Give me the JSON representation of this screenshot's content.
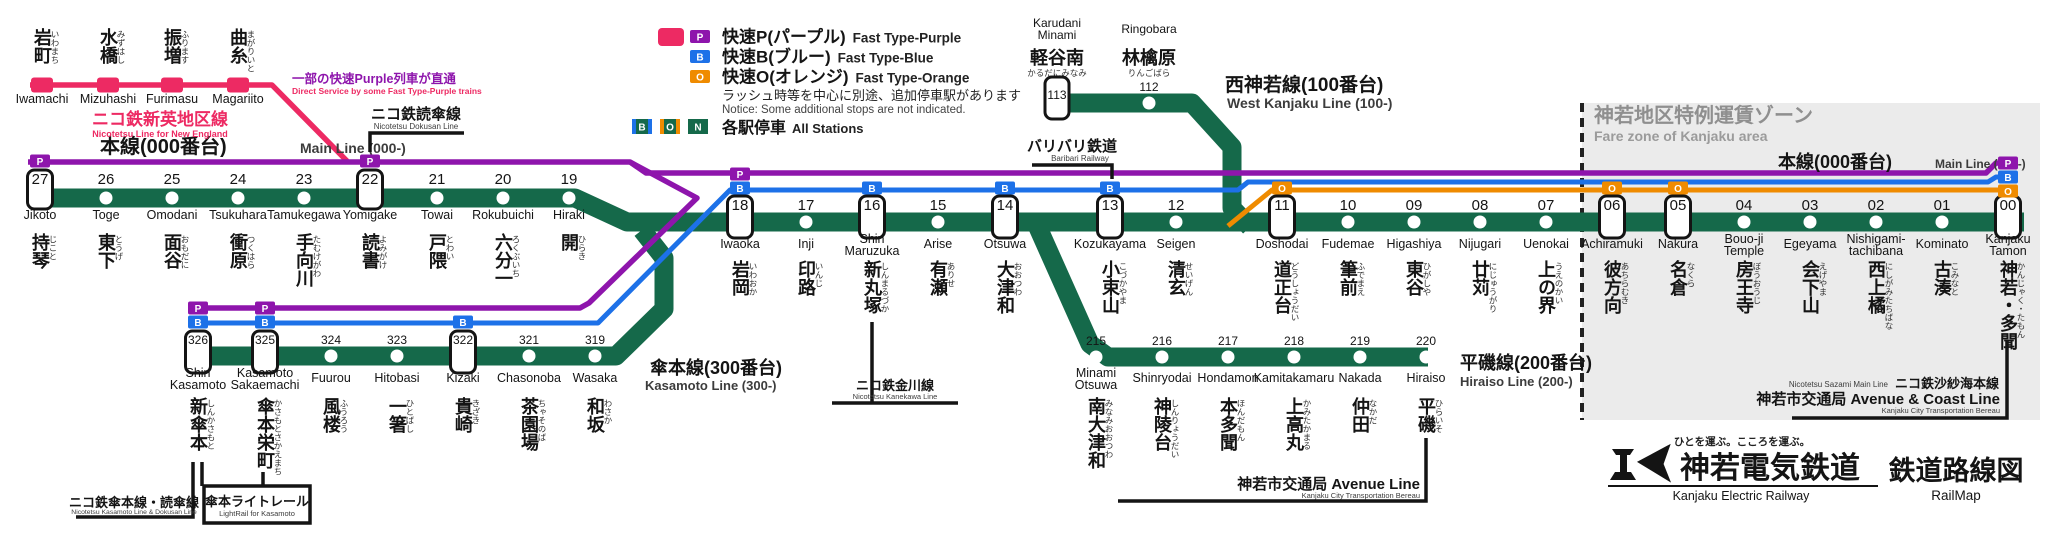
{
  "colors": {
    "green": "#15694A",
    "purple": "#8E15AC",
    "blue": "#1D71E8",
    "orange": "#EF8B00",
    "pink": "#ED2A63",
    "text": "#141414",
    "subtext": "#3C3C3C",
    "zone_bg": "#EBEBEB",
    "zone_text": "#8F8F8F",
    "white": "#FFFFFF"
  },
  "legend": {
    "rows": [
      {
        "badges": [
          "pink-rect",
          "P"
        ],
        "jp": "快速P(パープル)",
        "en": "Fast Type-Purple"
      },
      {
        "badges": [
          "B"
        ],
        "jp": "快速B(ブルー)",
        "en": "Fast Type-Blue"
      },
      {
        "badges": [
          "O"
        ],
        "jp": "快速O(オレンジ)",
        "en": "Fast Type-Orange"
      }
    ],
    "notice_jp": "ラッシュ時等を中心に別途、追加停車駅があります",
    "notice_en": "Notice: Some additional stops are not indicated.",
    "local": {
      "badges": [
        "B",
        "O",
        "N"
      ],
      "jp": "各駅停車",
      "en": "All Stations"
    }
  },
  "fare_zone": {
    "jp": "神若地区特例運賃ゾーン",
    "en": "Fare zone of Kanjaku area"
  },
  "line_labels": {
    "main_left": {
      "jp": "本線(000番台)",
      "en": "Main Line (000-)"
    },
    "main_right": {
      "jp": "本線(000番台)",
      "en": "Main Line (000-)"
    },
    "west": {
      "jp": "西神若線(100番台)",
      "en": "West Kanjaku Line (100-)"
    },
    "kasamoto": {
      "jp": "傘本線(300番台)",
      "en": "Kasamoto Line (300-)"
    },
    "hiraiso": {
      "jp": "平磯線(200番台)",
      "en": "Hiraiso Line (200-)"
    },
    "new_england": {
      "jp": "ニコ鉄新英地区線",
      "en": "Nicotetsu Line for New England",
      "note_jp": "一部の快速Purple列車が直通",
      "note_en": "Direct Service by some Fast Type-Purple trains"
    }
  },
  "stations": {
    "main_left": [
      {
        "num": "27",
        "name": "持琴",
        "kana": "じこと",
        "romaji": [
          "Jikoto"
        ],
        "x": 40,
        "fast": true,
        "badges": [
          "P"
        ]
      },
      {
        "num": "26",
        "name": "東下",
        "kana": "とうげ",
        "romaji": [
          "Toge"
        ],
        "x": 106
      },
      {
        "num": "25",
        "name": "面谷",
        "kana": "おもだに",
        "romaji": [
          "Omodani"
        ],
        "x": 172
      },
      {
        "num": "24",
        "name": "衝原",
        "kana": "つくはら",
        "romaji": [
          "Tsukuhara"
        ],
        "x": 238
      },
      {
        "num": "23",
        "name": "手向川",
        "kana": "たむけがわ",
        "romaji": [
          "Tamukegawa"
        ],
        "x": 304
      },
      {
        "num": "22",
        "name": "読書",
        "kana": "よみがけ",
        "romaji": [
          "Yomigake"
        ],
        "x": 370,
        "fast": true,
        "badges": [
          "P"
        ]
      },
      {
        "num": "21",
        "name": "戸隈",
        "kana": "とわい",
        "romaji": [
          "Towai"
        ],
        "x": 437
      },
      {
        "num": "20",
        "name": "六分一",
        "kana": "ろくぶいち",
        "romaji": [
          "Rokubuichi"
        ],
        "x": 503
      },
      {
        "num": "19",
        "name": "開",
        "kana": "ひらき",
        "romaji": [
          "Hiraki"
        ],
        "x": 569
      }
    ],
    "main_mid": [
      {
        "num": "18",
        "name": "岩岡",
        "kana": "いわおか",
        "romaji": [
          "Iwaoka"
        ],
        "x": 740,
        "fast": true,
        "badges": [
          "P",
          "B"
        ]
      },
      {
        "num": "17",
        "name": "印路",
        "kana": "いんじ",
        "romaji": [
          "Inji"
        ],
        "x": 806
      },
      {
        "num": "16",
        "name": "新丸塚",
        "kana": "しんまるづか",
        "romaji": [
          "Shin",
          "Maruzuka"
        ],
        "x": 872,
        "fast": true,
        "badges": [
          "B"
        ]
      },
      {
        "num": "15",
        "name": "有瀬",
        "kana": "ありせ",
        "romaji": [
          "Arise"
        ],
        "x": 938
      },
      {
        "num": "14",
        "name": "大津和",
        "kana": "おおつわ",
        "romaji": [
          "Otsuwa"
        ],
        "x": 1005,
        "fast": true,
        "badges": [
          "B"
        ]
      },
      {
        "num": "13",
        "name": "小束山",
        "kana": "こづかやま",
        "romaji": [
          "Kozukayama"
        ],
        "x": 1110,
        "fast": true,
        "badges": [
          "B"
        ]
      },
      {
        "num": "12",
        "name": "清玄",
        "kana": "せいげん",
        "romaji": [
          "Seigen"
        ],
        "x": 1176
      },
      {
        "num": "11",
        "name": "道正台",
        "kana": "どうしょうだい",
        "romaji": [
          "Doshodai"
        ],
        "x": 1282,
        "fast": true,
        "badges": [
          "O"
        ]
      },
      {
        "num": "10",
        "name": "筆前",
        "kana": "ふでまえ",
        "romaji": [
          "Fudemae"
        ],
        "x": 1348
      },
      {
        "num": "09",
        "name": "東谷",
        "kana": "ひがしや",
        "romaji": [
          "Higashiya"
        ],
        "x": 1414
      },
      {
        "num": "08",
        "name": "廿苅",
        "kana": "にじゅうがり",
        "romaji": [
          "Nijugari"
        ],
        "x": 1480
      },
      {
        "num": "07",
        "name": "上の界",
        "kana": "うえのかい",
        "romaji": [
          "Uenokai"
        ],
        "x": 1546
      },
      {
        "num": "06",
        "name": "彼方向",
        "kana": "あちらむき",
        "romaji": [
          "Achiramuki"
        ],
        "x": 1612,
        "fast": true,
        "badges": [
          "O"
        ]
      },
      {
        "num": "05",
        "name": "名倉",
        "kana": "なくら",
        "romaji": [
          "Nakura"
        ],
        "x": 1678,
        "fast": true,
        "badges": [
          "O"
        ]
      },
      {
        "num": "04",
        "name": "房王寺",
        "kana": "ぼうおうじ",
        "romaji": [
          "Bouo-ji",
          "Temple"
        ],
        "x": 1744
      },
      {
        "num": "03",
        "name": "会下山",
        "kana": "えげやま",
        "romaji": [
          "Egeyama"
        ],
        "x": 1810
      },
      {
        "num": "02",
        "name": "西上橘",
        "kana": "にしがみたちばな",
        "romaji": [
          "Nishigami-",
          "tachibana"
        ],
        "x": 1876
      },
      {
        "num": "01",
        "name": "古湊",
        "kana": "こみなと",
        "romaji": [
          "Kominato"
        ],
        "x": 1942
      },
      {
        "num": "00",
        "name": "神若・多聞",
        "kana": "かんじゃく・たもん",
        "romaji": [
          "Kanjaku",
          "Tamon"
        ],
        "x": 2008,
        "fast": true,
        "terminal": true
      }
    ],
    "pink": [
      {
        "name": "岩町",
        "kana": "いわまち",
        "romaji": [
          "Iwamachi"
        ],
        "x": 42
      },
      {
        "name": "水橋",
        "kana": "みずはし",
        "romaji": [
          "Mizuhashi"
        ],
        "x": 108
      },
      {
        "name": "振増",
        "kana": "ふります",
        "romaji": [
          "Furimasu"
        ],
        "x": 172
      },
      {
        "name": "曲糸",
        "kana": "まがりいと",
        "romaji": [
          "Magariito"
        ],
        "x": 238
      }
    ],
    "west": [
      {
        "num": "113",
        "name": "軽谷南",
        "kana": "かるだにみなみ",
        "romaji": [
          "Karudani",
          "Minami"
        ],
        "x": 1057,
        "fast": true
      },
      {
        "num": "112",
        "name": "林檎原",
        "kana": "りんごばら",
        "romaji": [
          "Ringobara"
        ],
        "x": 1149
      }
    ],
    "kasamoto": [
      {
        "num": "326",
        "name": "新傘本",
        "kana": "しんかさもと",
        "romaji": [
          "Shin",
          "Kasamoto"
        ],
        "x": 198,
        "fast": true,
        "badges": [
          "P",
          "B"
        ]
      },
      {
        "num": "325",
        "name": "傘本栄町",
        "kana": "かさもとさかえまち",
        "romaji": [
          "Kasamoto",
          "Sakaemachi"
        ],
        "x": 265,
        "fast": true,
        "badges": [
          "P",
          "B"
        ]
      },
      {
        "num": "324",
        "name": "風楼",
        "kana": "ふうろう",
        "romaji": [
          "Fuurou"
        ],
        "x": 331
      },
      {
        "num": "323",
        "name": "一箸",
        "kana": "ひとばし",
        "romaji": [
          "Hitobasi"
        ],
        "x": 397
      },
      {
        "num": "322",
        "name": "貴崎",
        "kana": "きざき",
        "romaji": [
          "Kizaki"
        ],
        "x": 463,
        "fast": true,
        "badges": [
          "B"
        ]
      },
      {
        "num": "321",
        "name": "茶園場",
        "kana": "ちゃそのば",
        "romaji": [
          "Chasonoba"
        ],
        "x": 529
      },
      {
        "num": "319",
        "name": "和坂",
        "kana": "わさか",
        "romaji": [
          "Wasaka"
        ],
        "x": 595
      }
    ],
    "hiraiso": [
      {
        "num": "215",
        "name": "南大津和",
        "kana": "みなみおおつわ",
        "romaji": [
          "Minami",
          "Otsuwa"
        ],
        "x": 1096
      },
      {
        "num": "216",
        "name": "神陵台",
        "kana": "しんりょうだい",
        "romaji": [
          "Shinryodai"
        ],
        "x": 1162
      },
      {
        "num": "217",
        "name": "本多聞",
        "kana": "ほんだもん",
        "romaji": [
          "Hondamon"
        ],
        "x": 1228
      },
      {
        "num": "218",
        "name": "上高丸",
        "kana": "かみたかまる",
        "romaji": [
          "Kamitakamaru"
        ],
        "x": 1294
      },
      {
        "num": "219",
        "name": "仲田",
        "kana": "なかだ",
        "romaji": [
          "Nakada"
        ],
        "x": 1360
      },
      {
        "num": "220",
        "name": "平磯",
        "kana": "ひらいそ",
        "romaji": [
          "Hiraiso"
        ],
        "x": 1426
      }
    ]
  },
  "connections": {
    "dokusan": {
      "jp": "ニコ鉄読傘線",
      "en": "Nicotetsu Dokusan Line"
    },
    "baribari": {
      "jp": "バリバリ鉄道",
      "en": "Baribari Railway"
    },
    "kanekawa": {
      "jp": "ニコ鉄金川線",
      "en": "Nicotetsu Kanekawa Line"
    },
    "avenue": {
      "jp": "神若市交通局 Avenue Line",
      "en": "Kanjaku City Transportation Bereau"
    },
    "sazami": {
      "en": "Nicotetsu Sazami Main Line",
      "jp": "ニコ鉄沙紗海本線",
      "jp2": "神若市交通局 Avenue & Coast Line",
      "en2": "Kanjaku City Transportation Bereau"
    },
    "kasamoto_dokusan": {
      "jp": "ニコ鉄傘本線・読傘線",
      "en": "Nicotetsu Kasamoto Line & Dokusan Line"
    },
    "lightrail": {
      "jp": "傘本ライトレール",
      "en": "LightRail for Kasamoto"
    }
  },
  "logo": {
    "tagline": "ひとを運ぶ。こころを運ぶ。",
    "company_jp": "神若電気鉄道",
    "company_en": "Kanjaku Electric Railway",
    "map_jp": "鉄道路線図",
    "map_en": "RailMap"
  }
}
